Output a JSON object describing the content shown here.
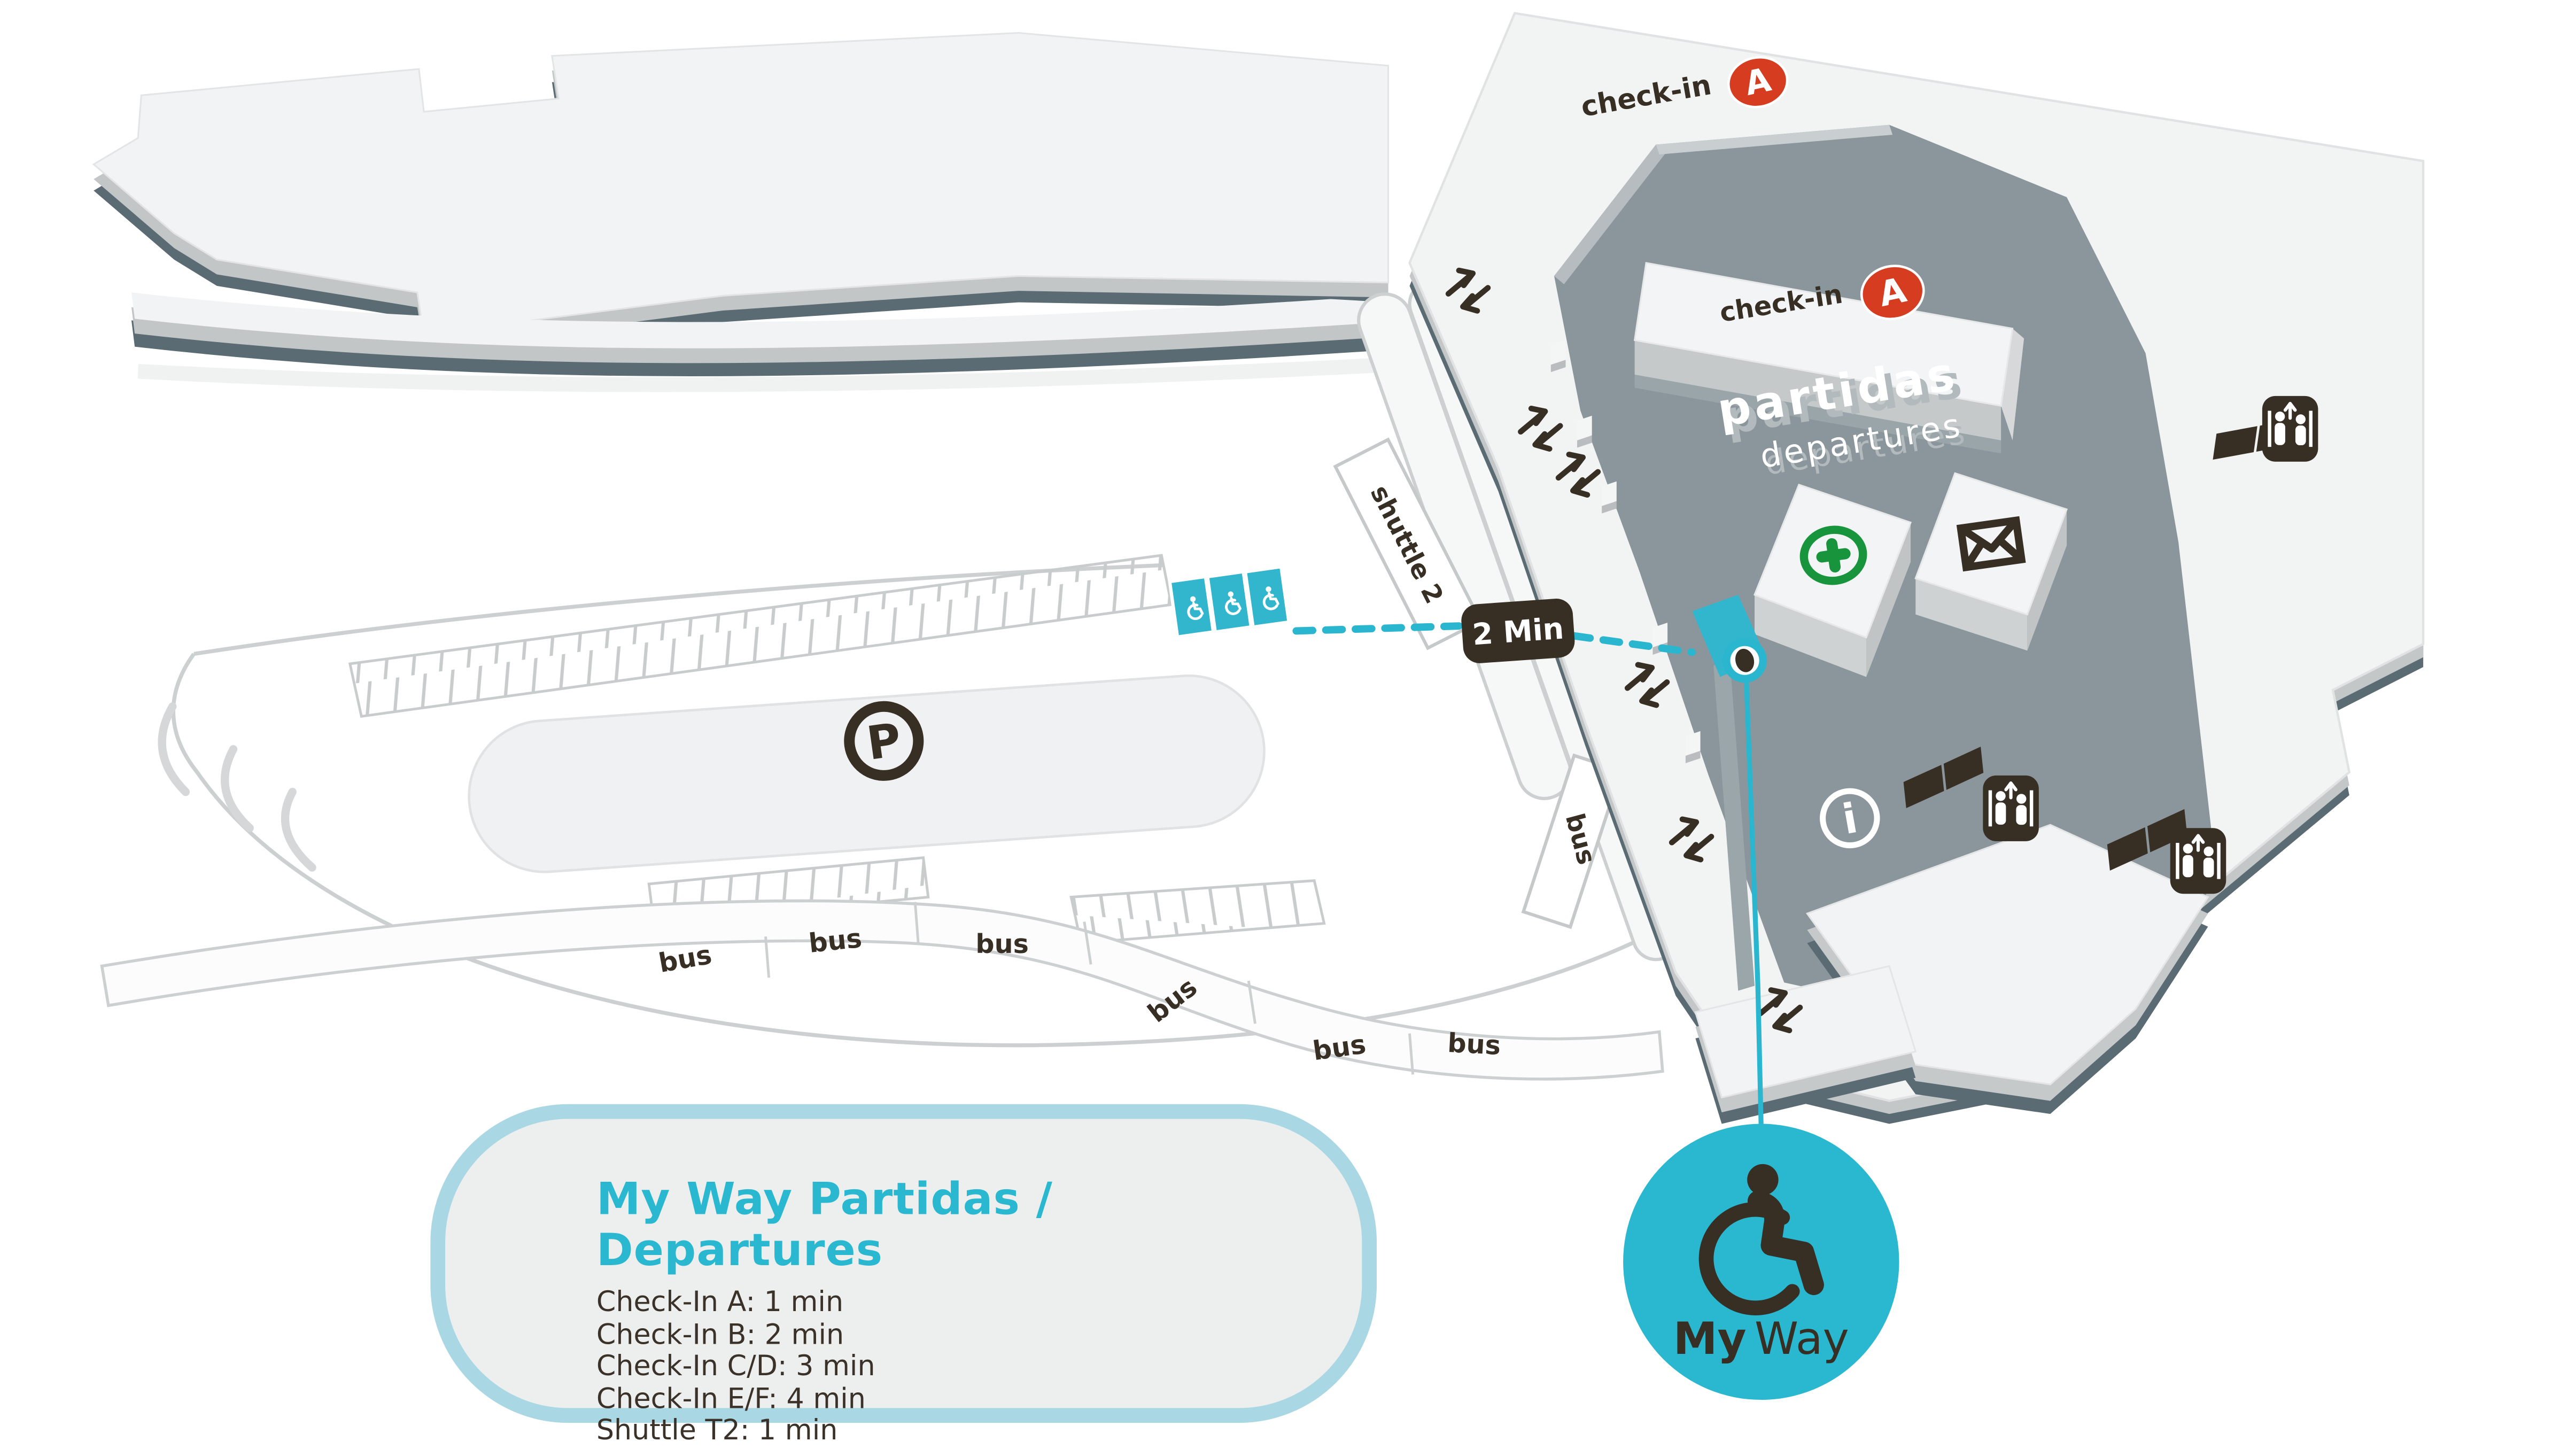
{
  "colors": {
    "accent_teal": "#29b8d0",
    "teal_light_border": "#a9d7e4",
    "checkin_red": "#d53c20",
    "dark_brown": "#372e24",
    "terminal_floor_gray": "#8b969c",
    "pharmacy_green": "#18953c",
    "building_white": "#f2f3f4"
  },
  "terminal": {
    "checkin_label": "check-in",
    "checkin_zone": "A",
    "area_name_pt": "partidas",
    "area_name_en": "departures"
  },
  "roads": {
    "shuttle_label": "shuttle 2",
    "bus_label": "bus",
    "parking_symbol": "P",
    "info_symbol": "i"
  },
  "route": {
    "time_badge": "2 Min"
  },
  "myway_badge": {
    "brand_bold": "My",
    "brand_light": "Way"
  },
  "legend": {
    "title": "My Way Partidas / Departures",
    "items": [
      "Check-In A: 1 min",
      "Check-In B: 2 min",
      "Check-In C/D: 3 min",
      "Check-In E/F: 4 min",
      "Shuttle T2: 1 min"
    ]
  }
}
